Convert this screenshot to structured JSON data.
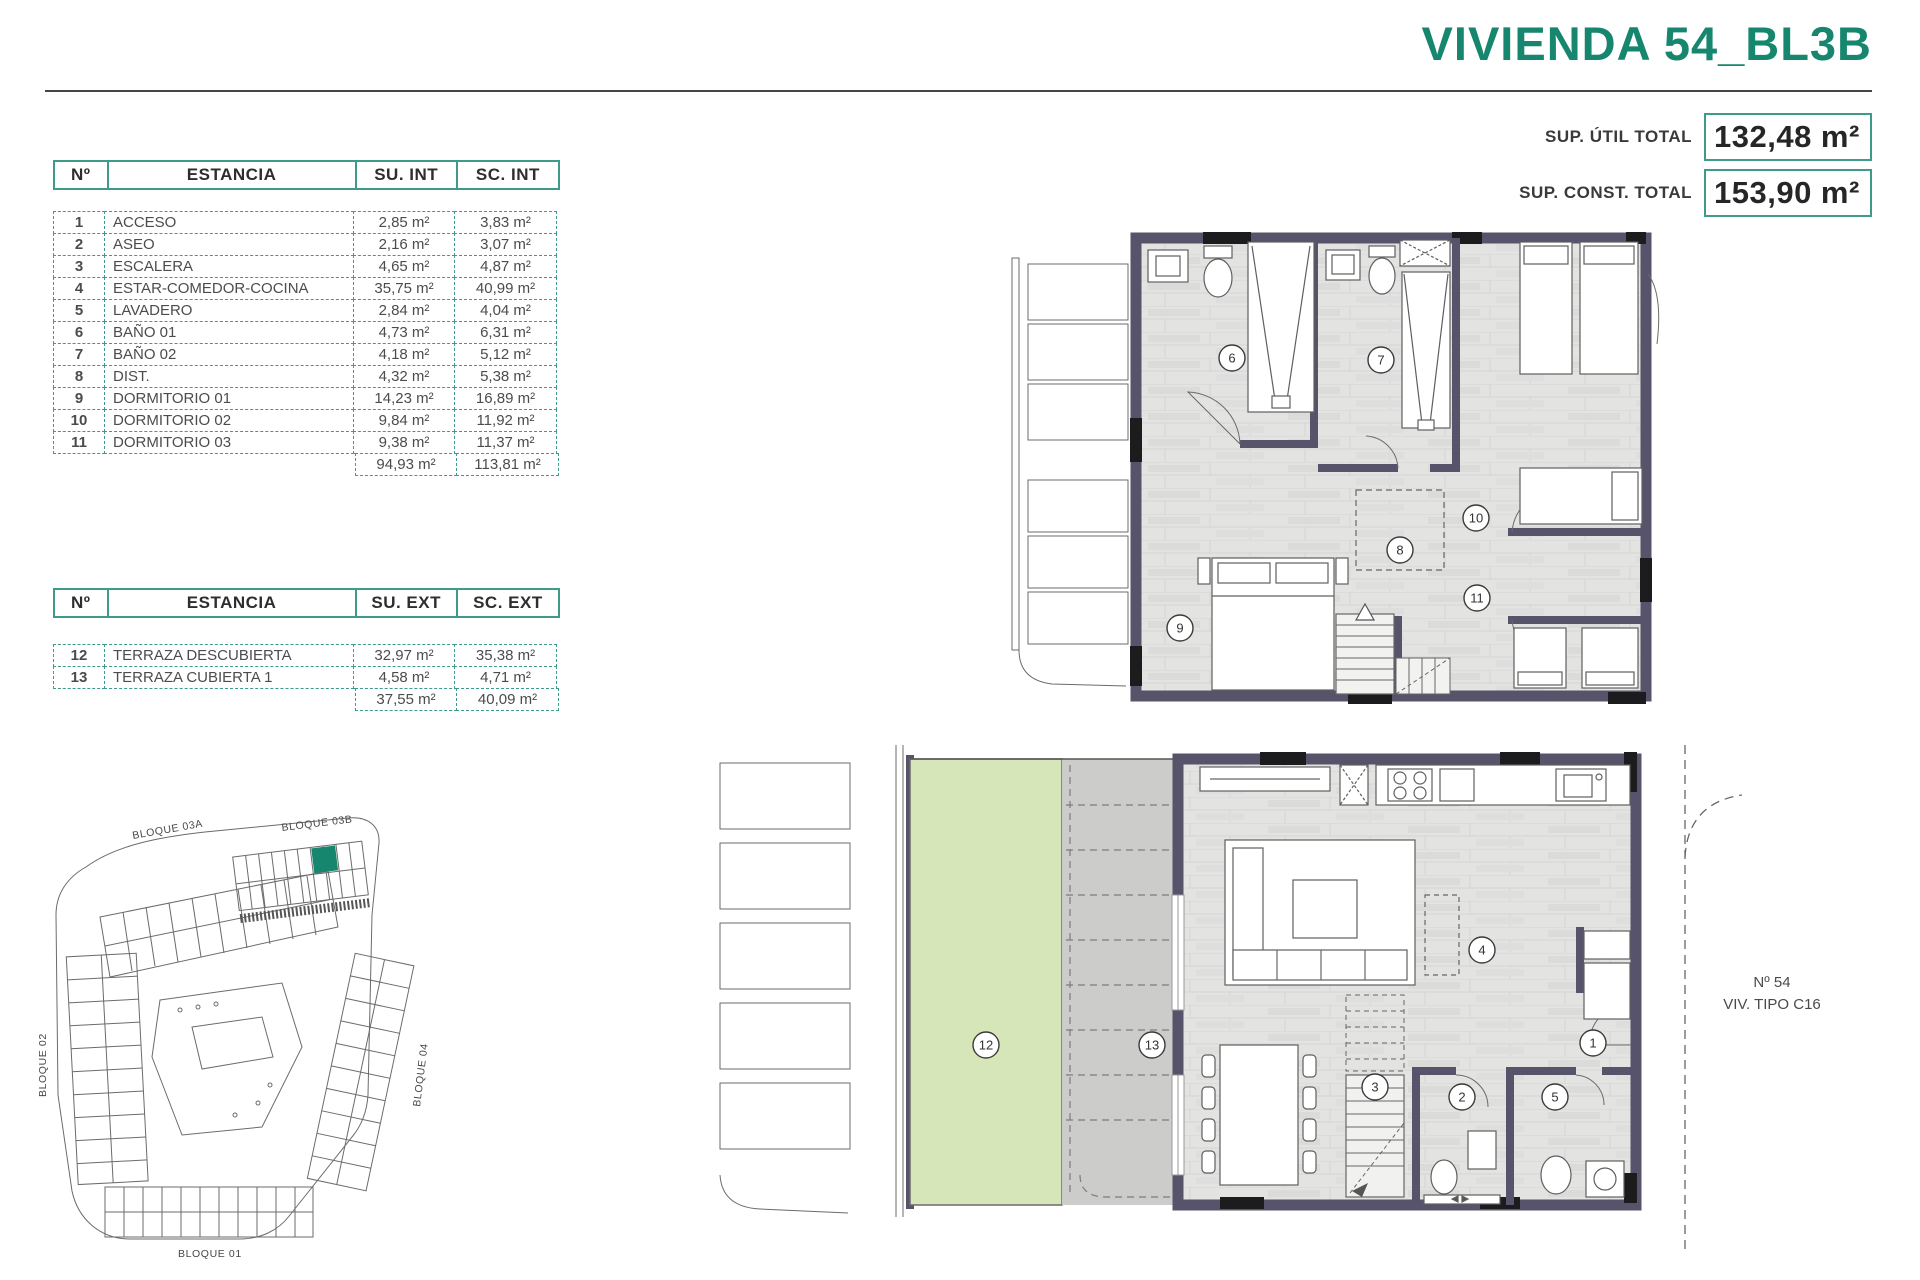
{
  "meta": {
    "title": "VIVIENDA 54_BL3B"
  },
  "summary": {
    "rows": [
      {
        "label": "SUP. ÚTIL TOTAL",
        "value": "132,48 m²"
      },
      {
        "label": "SUP. CONST. TOTAL",
        "value": "153,90 m²"
      }
    ]
  },
  "tables": [
    {
      "headers": {
        "n": "Nº",
        "room": "ESTANCIA",
        "su": "SU. INT",
        "sc": "SC. INT"
      },
      "rows": [
        {
          "n": "1",
          "room": "ACCESO",
          "su": "2,85 m²",
          "sc": "3,83 m²"
        },
        {
          "n": "2",
          "room": "ASEO",
          "su": "2,16 m²",
          "sc": "3,07 m²"
        },
        {
          "n": "3",
          "room": "ESCALERA",
          "su": "4,65 m²",
          "sc": "4,87 m²"
        },
        {
          "n": "4",
          "room": "ESTAR-COMEDOR-COCINA",
          "su": "35,75 m²",
          "sc": "40,99 m²"
        },
        {
          "n": "5",
          "room": "LAVADERO",
          "su": "2,84 m²",
          "sc": "4,04 m²"
        },
        {
          "n": "6",
          "room": "BAÑO 01",
          "su": "4,73 m²",
          "sc": "6,31 m²"
        },
        {
          "n": "7",
          "room": "BAÑO 02",
          "su": "4,18 m²",
          "sc": "5,12 m²"
        },
        {
          "n": "8",
          "room": "DIST.",
          "su": "4,32 m²",
          "sc": "5,38 m²"
        },
        {
          "n": "9",
          "room": "DORMITORIO 01",
          "su": "14,23 m²",
          "sc": "16,89 m²"
        },
        {
          "n": "10",
          "room": "DORMITORIO 02",
          "su": "9,84 m²",
          "sc": "11,92 m²"
        },
        {
          "n": "11",
          "room": "DORMITORIO 03",
          "su": "9,38 m²",
          "sc": "11,37 m²"
        }
      ],
      "total": {
        "su": "94,93 m²",
        "sc": "113,81 m²"
      }
    },
    {
      "headers": {
        "n": "Nº",
        "room": "ESTANCIA",
        "su": "SU. EXT",
        "sc": "SC. EXT"
      },
      "rows": [
        {
          "n": "12",
          "room": "TERRAZA DESCUBIERTA",
          "su": "32,97 m²",
          "sc": "35,38 m²"
        },
        {
          "n": "13",
          "room": "TERRAZA CUBIERTA 1",
          "su": "4,58 m²",
          "sc": "4,71 m²"
        }
      ],
      "total": {
        "su": "37,55 m²",
        "sc": "40,09 m²"
      }
    }
  ],
  "siteplan": {
    "b03a": "BLOQUE 03A",
    "b03b": "BLOQUE 03B",
    "b02": "BLOQUE 02",
    "b04": "BLOQUE 04",
    "b01": "BLOQUE 01"
  },
  "plans": {
    "upper": {
      "r6": "6",
      "r7": "7",
      "r8": "8",
      "r9": "9",
      "r10": "10",
      "r11": "11"
    },
    "lower": {
      "r1": "1",
      "r2": "2",
      "r3": "3",
      "r4": "4",
      "r5": "5",
      "r12": "12",
      "r13": "13",
      "unit_no": "Nº 54",
      "unit_type": "VIV. TIPO C16"
    }
  },
  "colors": {
    "accent": "#17866E",
    "table_border": "#3E9A89",
    "wall": "#57536A",
    "floor": "#E3E3E1",
    "terrace_green": "#D7E6B8",
    "deck_gray": "#CCCCCA"
  }
}
